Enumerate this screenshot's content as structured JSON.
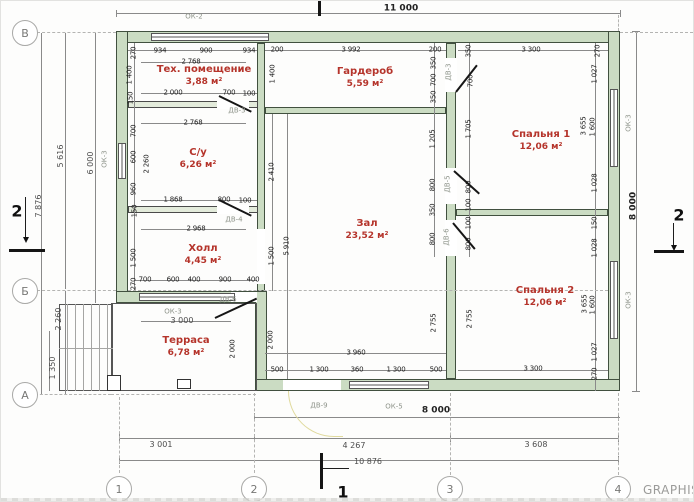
{
  "watermark": "GRAPHISO",
  "axis_markers": [
    {
      "label": "В",
      "x": 24,
      "y": 32
    },
    {
      "label": "Б",
      "x": 24,
      "y": 290
    },
    {
      "label": "А",
      "x": 24,
      "y": 394
    },
    {
      "label": "1",
      "x": 118,
      "y": 488
    },
    {
      "label": "2",
      "x": 253,
      "y": 488
    },
    {
      "label": "3",
      "x": 449,
      "y": 488
    },
    {
      "label": "4",
      "x": 617,
      "y": 488
    }
  ],
  "section_markers": [
    {
      "label": "2",
      "x": 16,
      "y": 210
    },
    {
      "label": "2",
      "x": 678,
      "y": 214
    },
    {
      "label": "1",
      "x": 342,
      "y": 491
    }
  ],
  "rooms": [
    {
      "name": "Тех. помещение",
      "area": "3,88 м²",
      "x": 203,
      "y": 75
    },
    {
      "name": "Гардероб",
      "area": "5,59 м²",
      "x": 364,
      "y": 77
    },
    {
      "name": "Спальня 1",
      "area": "12,06 м²",
      "x": 540,
      "y": 140
    },
    {
      "name": "С/у",
      "area": "6,26 м²",
      "x": 197,
      "y": 158
    },
    {
      "name": "Зал",
      "area": "23,52 м²",
      "x": 366,
      "y": 229
    },
    {
      "name": "Холл",
      "area": "4,45 м²",
      "x": 202,
      "y": 254
    },
    {
      "name": "Спальня 2",
      "area": "12,06 м²",
      "x": 544,
      "y": 296
    },
    {
      "name": "Терраса",
      "area": "6,78 м²",
      "x": 185,
      "y": 346
    }
  ],
  "opening_labels": [
    {
      "t": "ОК-2",
      "x": 193,
      "y": 16
    },
    {
      "t": "ОК-3",
      "x": 104,
      "y": 158,
      "r": 1
    },
    {
      "t": "ОК-3",
      "x": 172,
      "y": 311
    },
    {
      "t": "ОК-3",
      "x": 628,
      "y": 122,
      "r": 1
    },
    {
      "t": "ОК-3",
      "x": 628,
      "y": 299,
      "r": 1
    },
    {
      "t": "ОК-5",
      "x": 393,
      "y": 406
    },
    {
      "t": "ДВ-3",
      "x": 236,
      "y": 110
    },
    {
      "t": "ДВ-3",
      "x": 448,
      "y": 71,
      "r": 1
    },
    {
      "t": "ДВ-4",
      "x": 233,
      "y": 219
    },
    {
      "t": "ДВ-5",
      "x": 447,
      "y": 183,
      "r": 1
    },
    {
      "t": "ДВ-6",
      "x": 446,
      "y": 236,
      "r": 1
    },
    {
      "t": "ДВ-6",
      "x": 227,
      "y": 299
    },
    {
      "t": "ДВ-9",
      "x": 318,
      "y": 405
    }
  ],
  "dims": [
    {
      "t": "11 000",
      "x": 400,
      "y": 8,
      "s": "b"
    },
    {
      "t": "934",
      "x": 159,
      "y": 50
    },
    {
      "t": "900",
      "x": 205,
      "y": 50
    },
    {
      "t": "934",
      "x": 248,
      "y": 50
    },
    {
      "t": "270",
      "x": 133,
      "y": 52,
      "r": 1
    },
    {
      "t": "200",
      "x": 276,
      "y": 49
    },
    {
      "t": "3 992",
      "x": 350,
      "y": 49
    },
    {
      "t": "200",
      "x": 434,
      "y": 49
    },
    {
      "t": "3 300",
      "x": 530,
      "y": 49
    },
    {
      "t": "270",
      "x": 597,
      "y": 50,
      "r": 1
    },
    {
      "t": "2 768",
      "x": 190,
      "y": 61
    },
    {
      "t": "1 400",
      "x": 129,
      "y": 74,
      "r": 1
    },
    {
      "t": "1 400",
      "x": 272,
      "y": 73,
      "r": 1
    },
    {
      "t": "150",
      "x": 130,
      "y": 97,
      "r": 1
    },
    {
      "t": "2 000",
      "x": 172,
      "y": 92
    },
    {
      "t": "700",
      "x": 228,
      "y": 92
    },
    {
      "t": "100",
      "x": 248,
      "y": 93
    },
    {
      "t": "2 768",
      "x": 192,
      "y": 122
    },
    {
      "t": "350",
      "x": 433,
      "y": 62,
      "r": 1
    },
    {
      "t": "700",
      "x": 433,
      "y": 79,
      "r": 1
    },
    {
      "t": "350",
      "x": 433,
      "y": 96,
      "r": 1
    },
    {
      "t": "1 205",
      "x": 432,
      "y": 138,
      "r": 1
    },
    {
      "t": "800",
      "x": 432,
      "y": 184,
      "r": 1
    },
    {
      "t": "350",
      "x": 432,
      "y": 209,
      "r": 1
    },
    {
      "t": "800",
      "x": 432,
      "y": 238,
      "r": 1
    },
    {
      "t": "350",
      "x": 468,
      "y": 50,
      "r": 1
    },
    {
      "t": "700",
      "x": 470,
      "y": 80,
      "r": 1
    },
    {
      "t": "1 705",
      "x": 468,
      "y": 128,
      "r": 1
    },
    {
      "t": "800",
      "x": 468,
      "y": 186,
      "r": 1
    },
    {
      "t": "100",
      "x": 468,
      "y": 204,
      "r": 1
    },
    {
      "t": "100",
      "x": 468,
      "y": 222,
      "r": 1
    },
    {
      "t": "800",
      "x": 468,
      "y": 243,
      "r": 1
    },
    {
      "t": "1 027",
      "x": 594,
      "y": 73,
      "r": 1
    },
    {
      "t": "3 655",
      "x": 583,
      "y": 125,
      "r": 1
    },
    {
      "t": "1 600",
      "x": 592,
      "y": 126,
      "r": 1
    },
    {
      "t": "1 028",
      "x": 594,
      "y": 182,
      "r": 1
    },
    {
      "t": "150",
      "x": 594,
      "y": 222,
      "r": 1
    },
    {
      "t": "1 028",
      "x": 594,
      "y": 247,
      "r": 1
    },
    {
      "t": "3 655",
      "x": 584,
      "y": 303,
      "r": 1
    },
    {
      "t": "1 600",
      "x": 592,
      "y": 304,
      "r": 1
    },
    {
      "t": "1 027",
      "x": 594,
      "y": 351,
      "r": 1
    },
    {
      "t": "270",
      "x": 594,
      "y": 373,
      "r": 1
    },
    {
      "t": "700",
      "x": 133,
      "y": 130,
      "r": 1
    },
    {
      "t": "600",
      "x": 133,
      "y": 156,
      "r": 1
    },
    {
      "t": "2 260",
      "x": 146,
      "y": 163,
      "r": 1
    },
    {
      "t": "960",
      "x": 133,
      "y": 188,
      "r": 1
    },
    {
      "t": "150",
      "x": 134,
      "y": 210,
      "r": 1
    },
    {
      "t": "1 500",
      "x": 133,
      "y": 257,
      "r": 1
    },
    {
      "t": "270",
      "x": 133,
      "y": 283,
      "r": 1
    },
    {
      "t": "1 868",
      "x": 172,
      "y": 199
    },
    {
      "t": "800",
      "x": 223,
      "y": 199
    },
    {
      "t": "100",
      "x": 244,
      "y": 200
    },
    {
      "t": "2 968",
      "x": 195,
      "y": 228
    },
    {
      "t": "2 410",
      "x": 271,
      "y": 171,
      "r": 1
    },
    {
      "t": "1 500",
      "x": 271,
      "y": 255,
      "r": 1
    },
    {
      "t": "5 910",
      "x": 286,
      "y": 245,
      "r": 1
    },
    {
      "t": "700",
      "x": 144,
      "y": 279
    },
    {
      "t": "600",
      "x": 172,
      "y": 279
    },
    {
      "t": "400",
      "x": 193,
      "y": 279
    },
    {
      "t": "900",
      "x": 224,
      "y": 279
    },
    {
      "t": "400",
      "x": 252,
      "y": 279
    },
    {
      "t": "3 000",
      "x": 181,
      "y": 320,
      "s": "m"
    },
    {
      "t": "2 000",
      "x": 232,
      "y": 348,
      "r": 1
    },
    {
      "t": "2 000",
      "x": 270,
      "y": 339,
      "r": 1
    },
    {
      "t": "500",
      "x": 276,
      "y": 369
    },
    {
      "t": "1 300",
      "x": 318,
      "y": 369
    },
    {
      "t": "360",
      "x": 356,
      "y": 369
    },
    {
      "t": "1 300",
      "x": 395,
      "y": 369
    },
    {
      "t": "500",
      "x": 435,
      "y": 369
    },
    {
      "t": "3 960",
      "x": 355,
      "y": 352
    },
    {
      "t": "2 755",
      "x": 433,
      "y": 322,
      "r": 1
    },
    {
      "t": "2 755",
      "x": 469,
      "y": 318,
      "r": 1
    },
    {
      "t": "3 300",
      "x": 532,
      "y": 368
    },
    {
      "t": "8 000",
      "x": 435,
      "y": 410,
      "s": "b"
    },
    {
      "t": "8 000",
      "x": 633,
      "y": 205,
      "r": 1,
      "s": "b"
    },
    {
      "t": "3 001",
      "x": 160,
      "y": 444,
      "s": "m"
    },
    {
      "t": "4 267",
      "x": 353,
      "y": 445,
      "s": "m"
    },
    {
      "t": "3 608",
      "x": 535,
      "y": 444,
      "s": "m"
    },
    {
      "t": "10 876",
      "x": 367,
      "y": 461,
      "s": "m"
    },
    {
      "t": "5 616",
      "x": 60,
      "y": 155,
      "r": 1,
      "s": "m"
    },
    {
      "t": "6 000",
      "x": 90,
      "y": 162,
      "r": 1,
      "s": "m"
    },
    {
      "t": "7 876",
      "x": 38,
      "y": 205,
      "r": 1,
      "s": "m"
    },
    {
      "t": "2 260",
      "x": 58,
      "y": 318,
      "r": 1,
      "s": "m"
    },
    {
      "t": "1 350",
      "x": 52,
      "y": 367,
      "r": 1,
      "s": "m"
    }
  ]
}
